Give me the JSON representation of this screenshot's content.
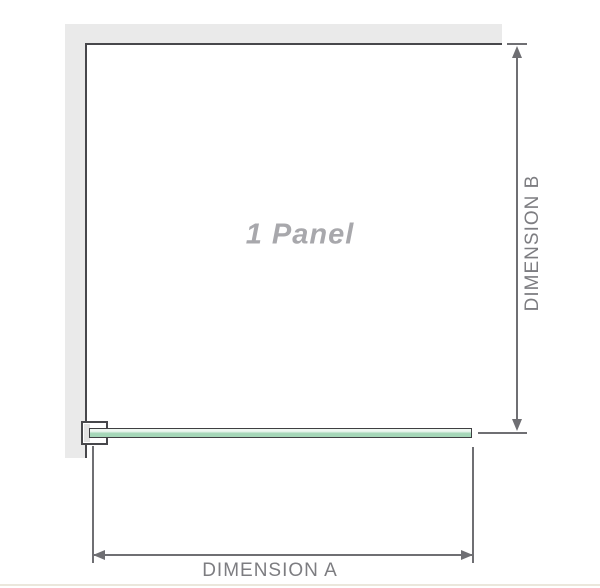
{
  "diagram": {
    "title": "1 Panel",
    "dimension_a_label": "DIMENSION A",
    "dimension_b_label": "DIMENSION B",
    "colors": {
      "wall": "#eaeaea",
      "panel_outline": "#47474b",
      "dimension": "#6f6f73",
      "label": "#7d7d81",
      "panel_title": "#a8a8ac",
      "glass_fill": "#a5d7b8",
      "glass_highlight": "#eef7f1",
      "glass_outline": "#3f3f42",
      "bracket_fill": "#ffffff",
      "bracket_block": "#e2e2e2",
      "footer_line": "#ebe7dc"
    }
  }
}
